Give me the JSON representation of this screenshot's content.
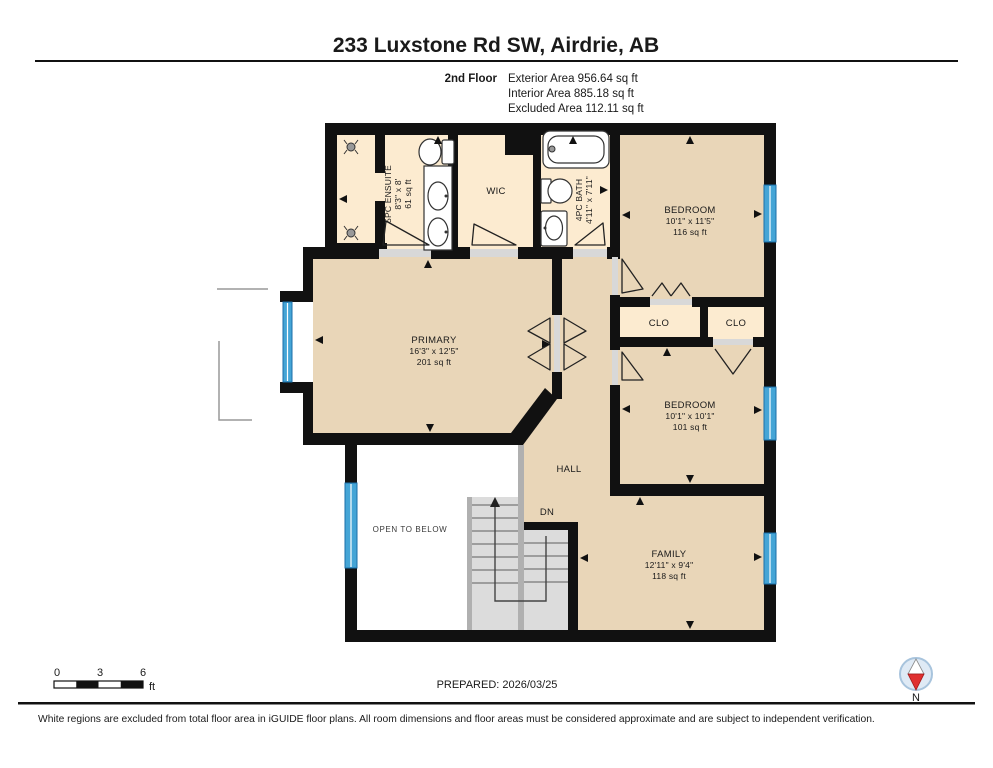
{
  "header": {
    "title": "233 Luxstone Rd SW, Airdrie, AB",
    "floor_label": "2nd Floor",
    "area_lines": [
      "Exterior Area 956.64 sq ft",
      "Interior Area 885.18 sq ft",
      "Excluded Area 112.11 sq ft"
    ]
  },
  "rooms": {
    "ensuite": {
      "name": "5PC ENSUITE",
      "dims": "8'3\" x 8'",
      "area": "61 sq ft"
    },
    "wic": {
      "name": "WIC"
    },
    "bath": {
      "name": "4PC BATH",
      "dims": "4'11\" x 7'11\""
    },
    "bedroom1": {
      "name": "BEDROOM",
      "dims": "10'1\" x 11'5\"",
      "area": "116 sq ft"
    },
    "primary": {
      "name": "PRIMARY",
      "dims": "16'3\" x 12'5\"",
      "area": "201 sq ft"
    },
    "clo1": {
      "name": "CLO"
    },
    "clo2": {
      "name": "CLO"
    },
    "bedroom2": {
      "name": "BEDROOM",
      "dims": "10'1\" x 10'1\"",
      "area": "101 sq ft"
    },
    "hall": {
      "name": "HALL"
    },
    "stairs": {
      "dn_label": "DN"
    },
    "open_below": {
      "name": "OPEN TO BELOW"
    },
    "family": {
      "name": "FAMILY",
      "dims": "12'11\" x 9'4\"",
      "area": "118 sq ft"
    }
  },
  "scale_bar": {
    "ticks": [
      "0",
      "3",
      "6"
    ],
    "unit": "ft"
  },
  "footer": {
    "prepared": "PREPARED: 2026/03/25",
    "disclaimer": "White regions are excluded from total floor area in iGUIDE floor plans. All room dimensions and floor areas must be considered approximate and are subject to independent verification."
  },
  "compass": {
    "north_label": "N"
  },
  "colors": {
    "wall": "#111111",
    "room_tan": "#e9d6b8",
    "room_cream": "#fcebd0",
    "window_blue": "#45a5d6",
    "stair_gray": "#dcdcdc",
    "door_sill_gray": "#d8d8d8",
    "compass_red": "#e03030"
  }
}
